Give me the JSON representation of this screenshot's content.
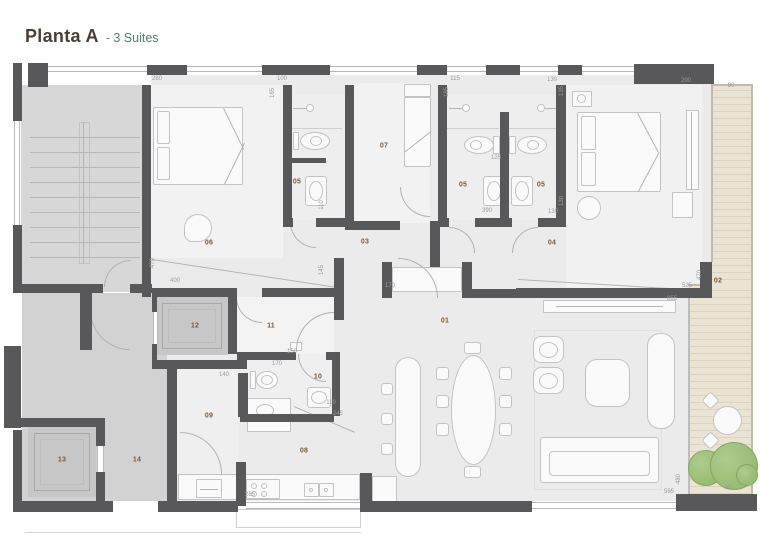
{
  "title": {
    "main": "Planta A",
    "subtitle": "- 3 Suites"
  },
  "colors": {
    "wall": "#58585a",
    "title_main": "#4a3f35",
    "title_subtitle": "#4e7d6e",
    "room_label": "#7a5a3d",
    "dimension_label": "#9c9c9c",
    "deck": "#ebe3d3",
    "tree": "#8db468"
  },
  "room_labels": [
    {
      "id": "01",
      "text": "01",
      "x": 445,
      "y": 321
    },
    {
      "id": "02",
      "text": "02",
      "x": 718,
      "y": 281
    },
    {
      "id": "03",
      "text": "03",
      "x": 365,
      "y": 242
    },
    {
      "id": "04",
      "text": "04",
      "x": 552,
      "y": 243
    },
    {
      "id": "05a",
      "text": "05",
      "x": 297,
      "y": 182
    },
    {
      "id": "05b",
      "text": "05",
      "x": 463,
      "y": 185
    },
    {
      "id": "05c",
      "text": "05",
      "x": 541,
      "y": 185
    },
    {
      "id": "06",
      "text": "06",
      "x": 209,
      "y": 243
    },
    {
      "id": "07",
      "text": "07",
      "x": 384,
      "y": 146
    },
    {
      "id": "08",
      "text": "08",
      "x": 304,
      "y": 451
    },
    {
      "id": "09",
      "text": "09",
      "x": 209,
      "y": 416
    },
    {
      "id": "10",
      "text": "10",
      "x": 318,
      "y": 377
    },
    {
      "id": "11",
      "text": "11",
      "x": 271,
      "y": 326
    },
    {
      "id": "12",
      "text": "12",
      "x": 195,
      "y": 326
    },
    {
      "id": "13",
      "text": "13",
      "x": 62,
      "y": 460
    },
    {
      "id": "14",
      "text": "14",
      "x": 137,
      "y": 460
    }
  ],
  "dimension_labels": [
    {
      "text": "280",
      "x": 157,
      "y": 79,
      "rot": false
    },
    {
      "text": "100",
      "x": 282,
      "y": 79,
      "rot": false
    },
    {
      "text": "185",
      "x": 273,
      "y": 93,
      "rot": true
    },
    {
      "text": "115",
      "x": 455,
      "y": 79,
      "rot": false
    },
    {
      "text": "185",
      "x": 447,
      "y": 92,
      "rot": true
    },
    {
      "text": "130",
      "x": 552,
      "y": 80,
      "rot": false
    },
    {
      "text": "135",
      "x": 562,
      "y": 91,
      "rot": true
    },
    {
      "text": "290",
      "x": 686,
      "y": 81,
      "rot": false
    },
    {
      "text": "90",
      "x": 731,
      "y": 86,
      "rot": false
    },
    {
      "text": "125",
      "x": 496,
      "y": 158,
      "rot": false
    },
    {
      "text": "390",
      "x": 487,
      "y": 211,
      "rot": false
    },
    {
      "text": "130",
      "x": 553,
      "y": 212,
      "rot": false
    },
    {
      "text": "130",
      "x": 562,
      "y": 201,
      "rot": true
    },
    {
      "text": "110",
      "x": 322,
      "y": 205,
      "rot": true
    },
    {
      "text": "470",
      "x": 153,
      "y": 263,
      "rot": true
    },
    {
      "text": "400",
      "x": 175,
      "y": 281,
      "rot": false
    },
    {
      "text": "145",
      "x": 322,
      "y": 270,
      "rot": true
    },
    {
      "text": "170",
      "x": 390,
      "y": 286,
      "rot": false
    },
    {
      "text": "525",
      "x": 687,
      "y": 286,
      "rot": false
    },
    {
      "text": "470",
      "x": 700,
      "y": 275,
      "rot": true
    },
    {
      "text": "855",
      "x": 672,
      "y": 299,
      "rot": false
    },
    {
      "text": "150",
      "x": 292,
      "y": 352,
      "rot": false
    },
    {
      "text": "170",
      "x": 277,
      "y": 364,
      "rot": false
    },
    {
      "text": "140",
      "x": 224,
      "y": 375,
      "rot": false
    },
    {
      "text": "110",
      "x": 331,
      "y": 403,
      "rot": false
    },
    {
      "text": "245",
      "x": 338,
      "y": 414,
      "rot": false
    },
    {
      "text": "265",
      "x": 250,
      "y": 495,
      "rot": false
    },
    {
      "text": "480",
      "x": 679,
      "y": 479,
      "rot": true
    },
    {
      "text": "595",
      "x": 669,
      "y": 492,
      "rot": false
    },
    {
      "text": "65",
      "x": 728,
      "y": 488,
      "rot": false
    }
  ]
}
